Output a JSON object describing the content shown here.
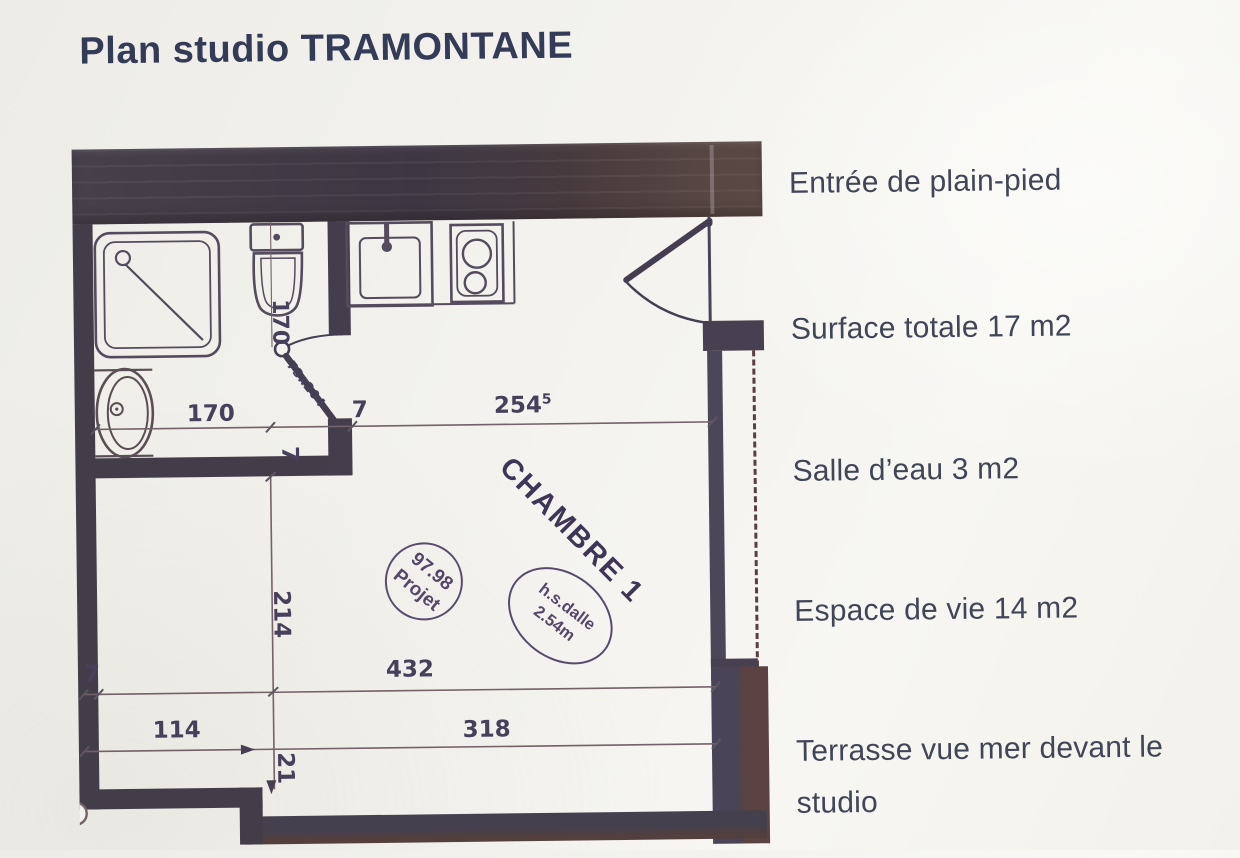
{
  "title": "Plan studio TRAMONTANE",
  "annotations": {
    "entry": "Entrée de plain-pied",
    "surface": "Surface totale 17 m2",
    "bathroom": "Salle d’eau 3 m2",
    "living": "Espace de vie 14 m2",
    "terrace": "Terrasse vue mer devant le studio"
  },
  "plan": {
    "room_label": "CHAMBRE 1",
    "stamps": {
      "project_stamp": {
        "line1": "97.98",
        "line2": "Projet"
      },
      "ceiling_stamp": {
        "line1": "h.s.dalle",
        "line2": "2.54m"
      }
    },
    "dimensions": {
      "bath_width": "170",
      "top_wall_thickness": "7",
      "room_width": "254",
      "room_width_sup": "5",
      "bath_door_size": "73x204",
      "bath_depth_rot": "170",
      "mid_wall_thickness_rot": "7",
      "living_depth": "214",
      "left_wall_thickness": "7",
      "living_width": "432",
      "bottom_left_width": "114",
      "bottom_right_width": "318",
      "step_depth": "21"
    },
    "icons": {
      "shower-icon": "rounded square tray with diagonal and drain",
      "toilet-icon": "tank rectangle with oval bowl",
      "washbasin-icon": "oval basin with drain dot",
      "kitchen-sink-icon": "square basin with faucet",
      "cooktop-icon": "two burner circles in rectangle",
      "entrance-door-icon": "door leaf with quarter swing arc",
      "bathroom-door-icon": "door leaf with hinge circle and swing arc"
    }
  },
  "colors": {
    "paper": "#f3f2ee",
    "ink": "#414657",
    "title_ink": "#333b56",
    "wall_dark": "#433d4a",
    "wall_brown": "#5a4342",
    "line": "#544b5c",
    "dim_line": "#75616a",
    "stamp": "#584a6b"
  }
}
